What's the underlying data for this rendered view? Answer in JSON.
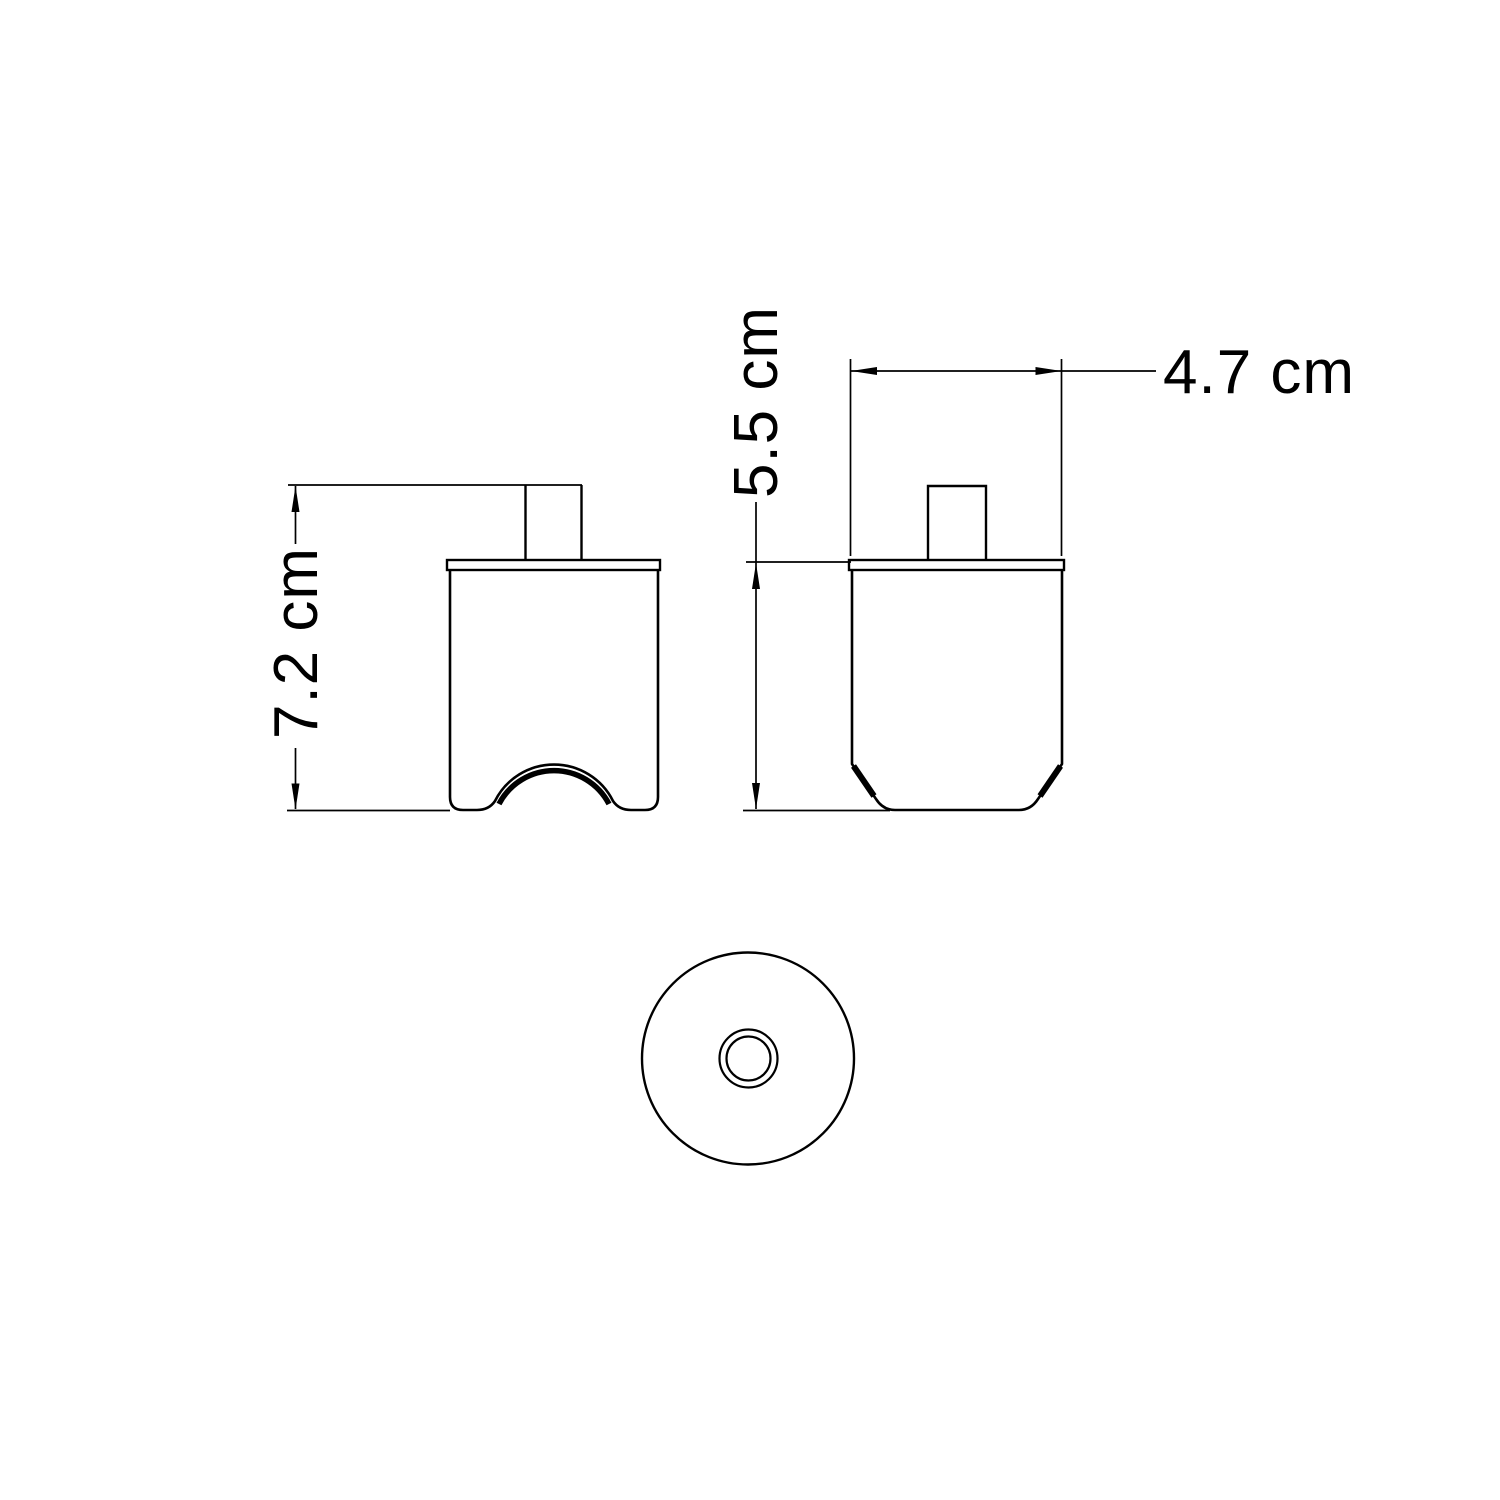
{
  "drawing": {
    "labels": {
      "overall_height": "7.2 cm",
      "body_height": "5.5 cm",
      "body_width": "4.7 cm"
    },
    "colors": {
      "line": "#000000",
      "background": "#ffffff"
    }
  }
}
